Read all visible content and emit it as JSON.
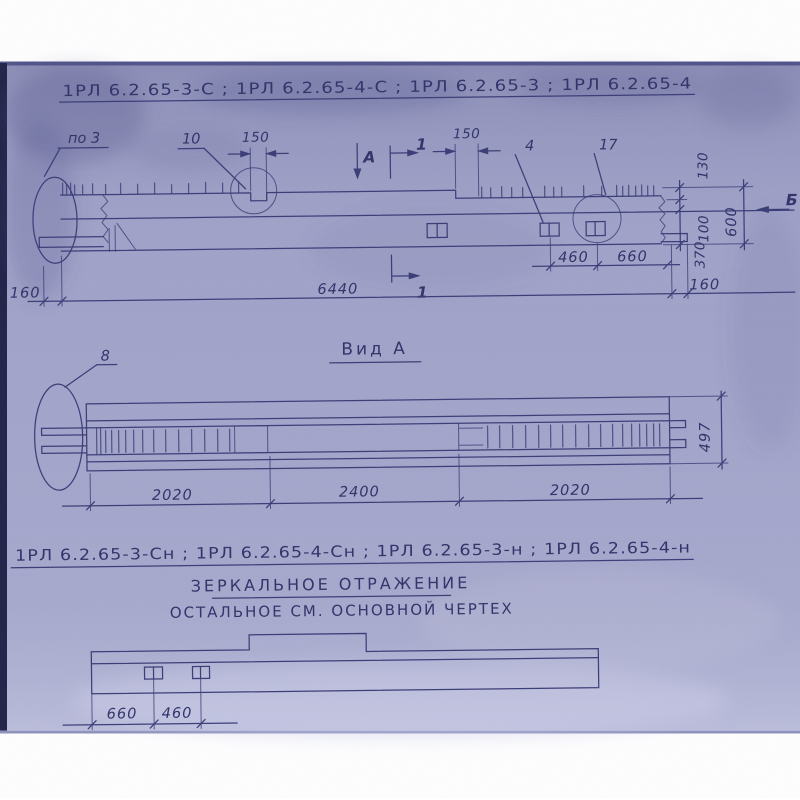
{
  "colors": {
    "page_background": "#ffffff",
    "paper": "#a4a6cb",
    "paper_bottom_light": "#c9cbe2",
    "scan_edge_dark": "#23254a",
    "scan_frame_line": "#54568c",
    "ink": "#3d3f78",
    "text_ink": "#33356b"
  },
  "header": {
    "title": "1РЛ 6.2.65-3-С ;  1РЛ 6.2.65-4-С ;  1РЛ 6.2.65-3 ;  1РЛ 6.2.65-4"
  },
  "elevation": {
    "callout_po3": "по 3",
    "callout_10": "10",
    "dim_150_left": "150",
    "dim_150_right": "150",
    "callout_4": "4",
    "callout_17": "17",
    "view_arrow_a": "А",
    "section_mark_1_top": "1",
    "section_mark_1_bottom": "1",
    "section_mark_b": "Б",
    "dim_460": "460",
    "dim_660": "660",
    "dim_130": "130",
    "dim_100": "100",
    "dim_370": "370",
    "dim_600": "600",
    "dim_160_left": "160",
    "dim_6440": "6440",
    "dim_160_right": "160"
  },
  "view_a": {
    "title": "Вид А",
    "callout_8": "8",
    "dim_2020_left": "2020",
    "dim_2400": "2400",
    "dim_2020_right": "2020",
    "dim_497": "497"
  },
  "mirror_block": {
    "title": "1РЛ 6.2.65-3-Сн ;  1РЛ 6.2.65-4-Сн ;  1РЛ 6.2.65-3-н ;  1РЛ 6.2.65-4-н",
    "caption_1": "ЗЕРКАЛЬНОЕ  ОТРАЖЕНИЕ",
    "caption_2": "ОСТАЛЬНОЕ  СМ.  ОСНОВНОЙ  ЧЕРТЕХ",
    "dim_660": "660",
    "dim_460": "460"
  }
}
